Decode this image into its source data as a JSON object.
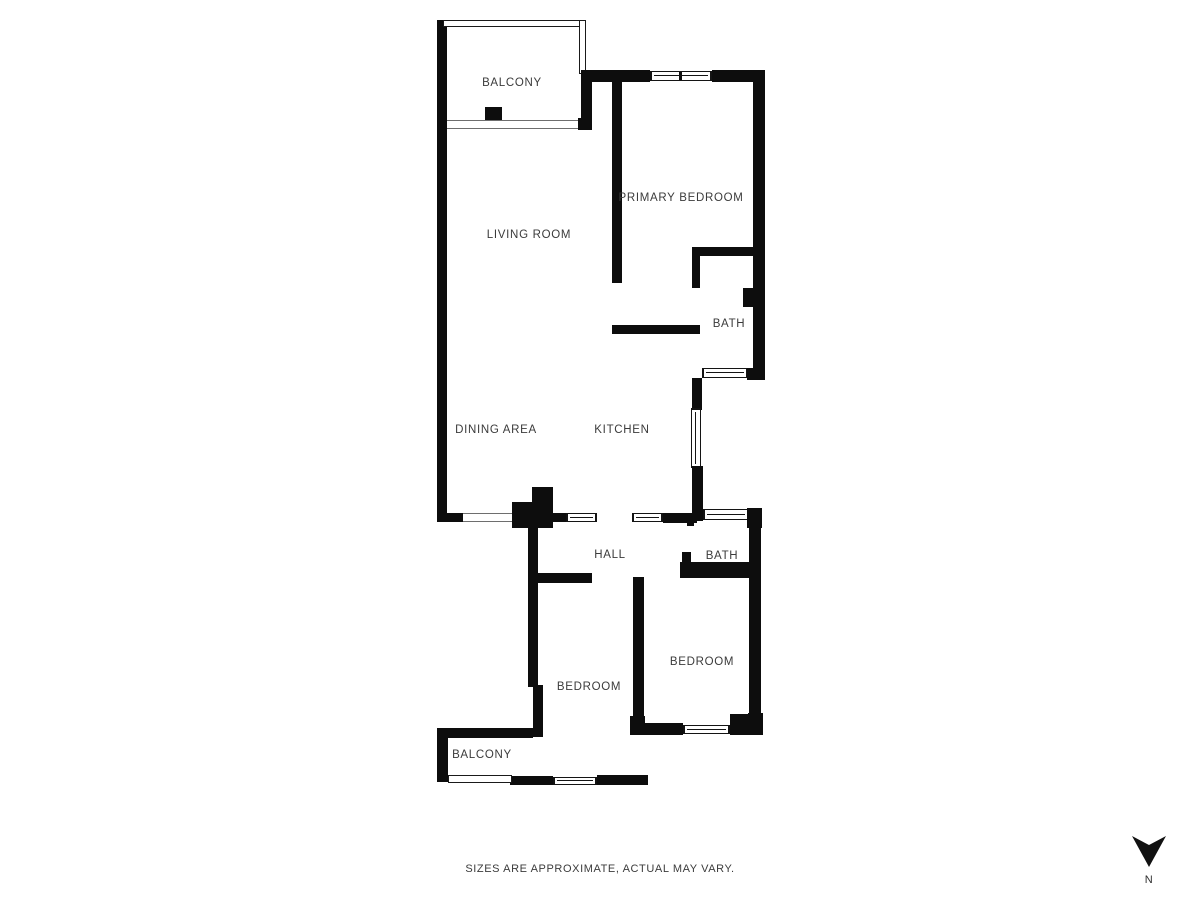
{
  "title": "Apartment floor plan",
  "colors": {
    "wall": "#0d0d0d",
    "text": "#3b3b3b",
    "background": "#ffffff"
  },
  "rooms": [
    {
      "id": "balcony-top",
      "label": "BALCONY"
    },
    {
      "id": "primary-bedroom",
      "label": "PRIMARY BEDROOM"
    },
    {
      "id": "living-room",
      "label": "LIVING ROOM"
    },
    {
      "id": "bath-top",
      "label": "BATH"
    },
    {
      "id": "dining-area",
      "label": "DINING AREA"
    },
    {
      "id": "kitchen",
      "label": "KITCHEN"
    },
    {
      "id": "hall",
      "label": "HALL"
    },
    {
      "id": "bath-bottom",
      "label": "BATH"
    },
    {
      "id": "bedroom-left",
      "label": "BEDROOM"
    },
    {
      "id": "bedroom-right",
      "label": "BEDROOM"
    },
    {
      "id": "balcony-bottom",
      "label": "BALCONY"
    }
  ],
  "footer": {
    "disclaimer": "SIZES ARE APPROXIMATE, ACTUAL MAY VARY."
  },
  "compass": {
    "label": "N"
  }
}
